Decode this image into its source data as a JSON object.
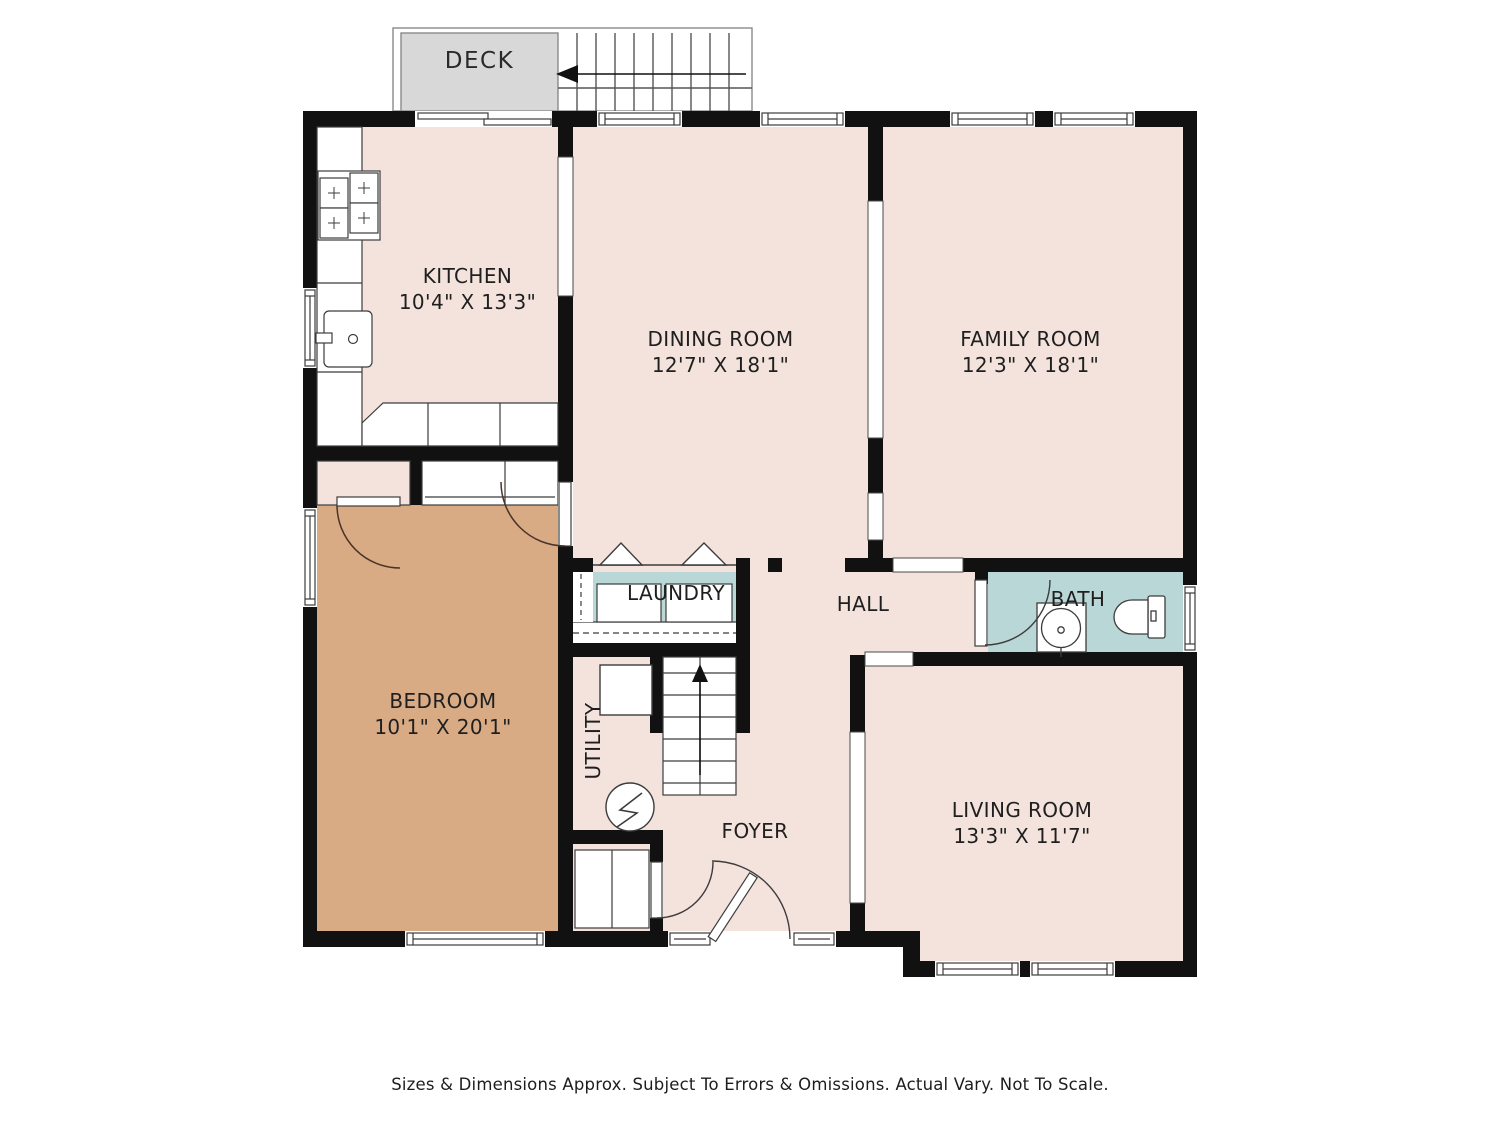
{
  "rooms": [
    {
      "key": "deck",
      "label": "DECK",
      "dims": ""
    },
    {
      "key": "kitchen",
      "label": "KITCHEN",
      "dims": "10'4\" X 13'3\""
    },
    {
      "key": "dining_room",
      "label": "DINING ROOM",
      "dims": "12'7\" X 18'1\""
    },
    {
      "key": "family_room",
      "label": "FAMILY ROOM",
      "dims": "12'3\" X 18'1\""
    },
    {
      "key": "bedroom",
      "label": "BEDROOM",
      "dims": "10'1\" X 20'1\""
    },
    {
      "key": "laundry",
      "label": "LAUNDRY",
      "dims": ""
    },
    {
      "key": "hall",
      "label": "HALL",
      "dims": ""
    },
    {
      "key": "bath",
      "label": "BATH",
      "dims": ""
    },
    {
      "key": "utility",
      "label": "UTILITY",
      "dims": ""
    },
    {
      "key": "foyer",
      "label": "FOYER",
      "dims": ""
    },
    {
      "key": "living_room",
      "label": "LIVING ROOM",
      "dims": "13'3\" X 11'7\""
    }
  ],
  "footer": "Sizes & Dimensions Approx. Subject To Errors & Omissions. Actual Vary. Not To Scale.",
  "colors": {
    "floor": "#f3e3dc",
    "bedroom_floor": "#d8ab85",
    "wet_floor": "#b9d7d6",
    "deck": "#d8d8d8",
    "wall": "#111111"
  }
}
